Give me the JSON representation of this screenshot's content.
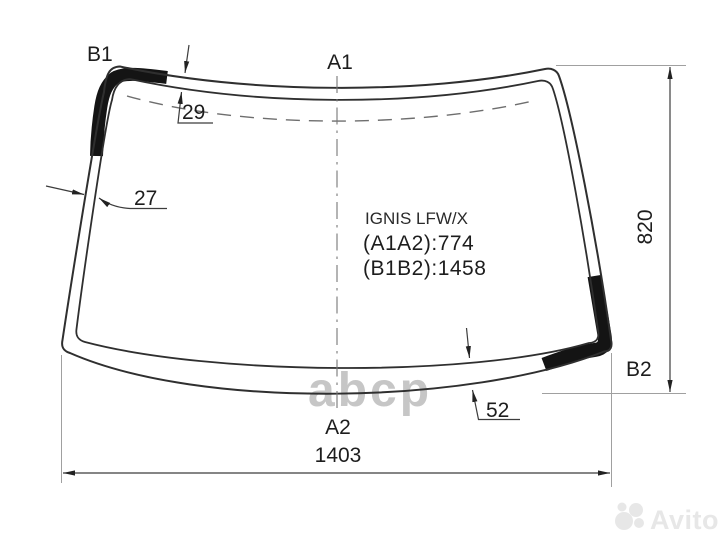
{
  "title_block": {
    "part_code": "IGNIS LFW/X",
    "spec_a": "(A1A2):774",
    "spec_b": "(B1B2):1458"
  },
  "corner_labels": {
    "b1": "B1",
    "a1": "A1",
    "b2": "B2",
    "a2": "A2"
  },
  "measurements": {
    "top_band_width": "29",
    "left_band_width": "27",
    "bottom_band_width": "52",
    "glass_height": "820",
    "glass_width": "1403"
  },
  "watermarks": {
    "parts_logo": "abcp",
    "marketplace": "Avito"
  },
  "colors": {
    "outline": "#2f2f2f",
    "ceramic_band": "#141414",
    "dimension_line": "#3c3c3c",
    "extension_line": "#a0a0a0",
    "dashed_guide": "#6e6e6e",
    "watermark_gray": "#c6c6c6",
    "watermark_faint": "#e7e7e7",
    "background": "#ffffff"
  }
}
